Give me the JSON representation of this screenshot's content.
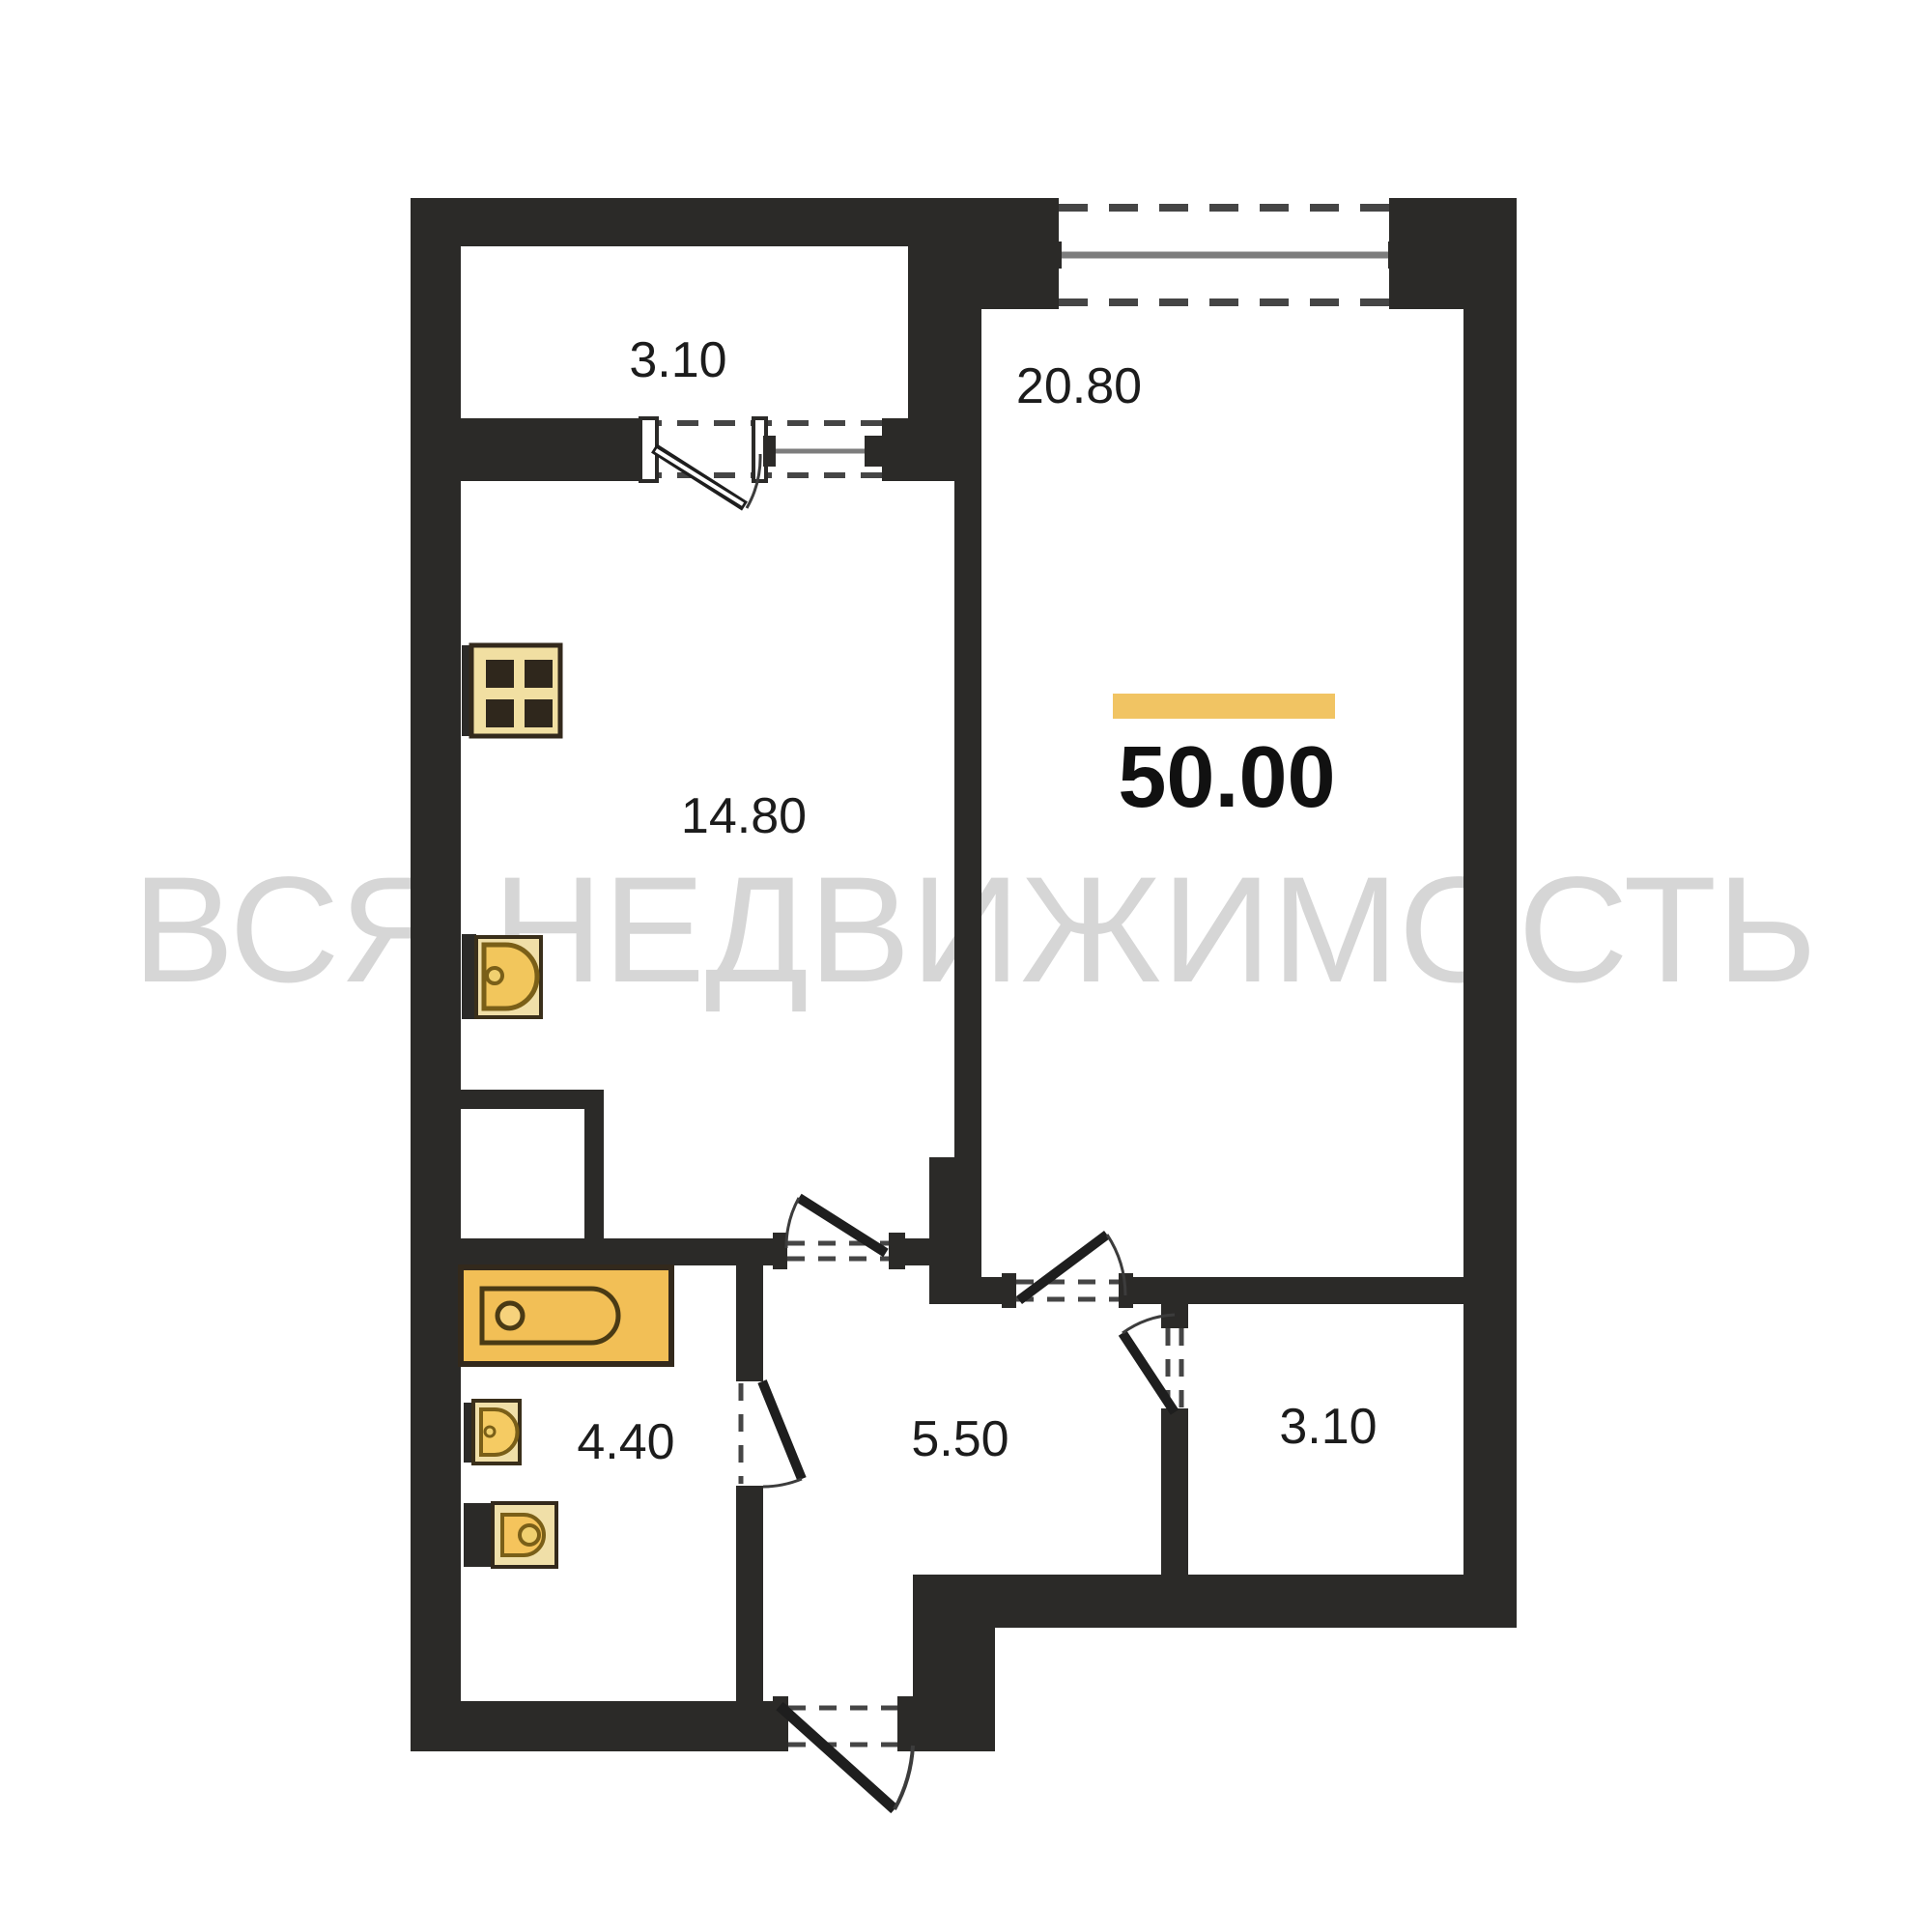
{
  "watermark": "ВСЯ НЕДВИЖИМОСТЬ",
  "total_area": "50.00",
  "rooms": {
    "balcony": "3.10",
    "living_room": "20.80",
    "kitchen": "14.80",
    "bathroom": "4.40",
    "hallway": "5.50",
    "storage": "3.10"
  },
  "icons": {
    "stove": "stove-icon",
    "kitchen_sink": "sink-icon",
    "bathtub": "bathtub-icon",
    "bathroom_sink": "washbasin-icon",
    "toilet": "toilet-icon"
  },
  "colors": {
    "wall": "#2b2a28",
    "accent_bar": "#f1c463",
    "fixture_gold": "#f2c65c",
    "fixture_cream": "#f0dfa8",
    "watermark": "#d4d4d4"
  }
}
